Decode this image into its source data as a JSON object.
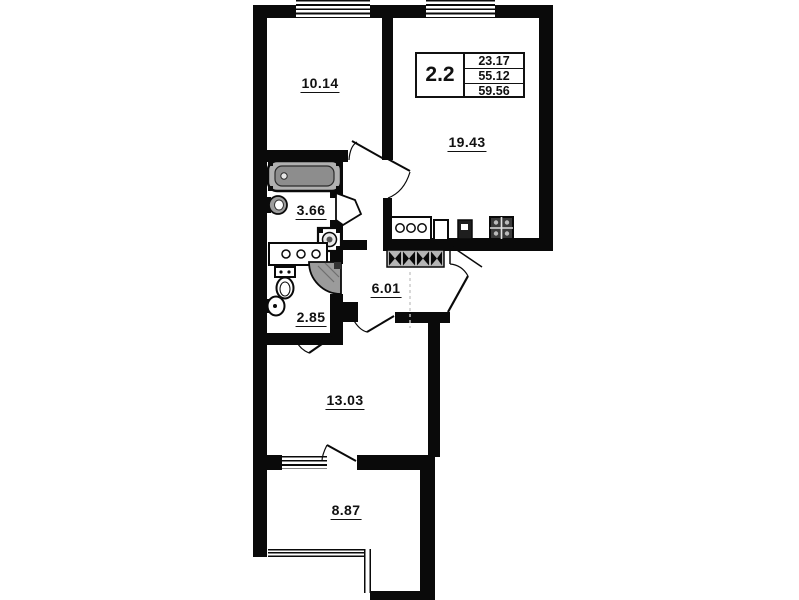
{
  "colors": {
    "wall": "#0a0a0a",
    "background": "#ffffff",
    "fixture_gray": "#a8a8a8",
    "text": "#111111"
  },
  "title_block": {
    "type": "2.2",
    "values": [
      "23.17",
      "55.12",
      "59.56"
    ]
  },
  "rooms": [
    {
      "area": "10.14"
    },
    {
      "area": "19.43"
    },
    {
      "area": "3.66"
    },
    {
      "area": "6.01"
    },
    {
      "area": "2.85"
    },
    {
      "area": "13.03"
    },
    {
      "area": "8.87"
    }
  ]
}
